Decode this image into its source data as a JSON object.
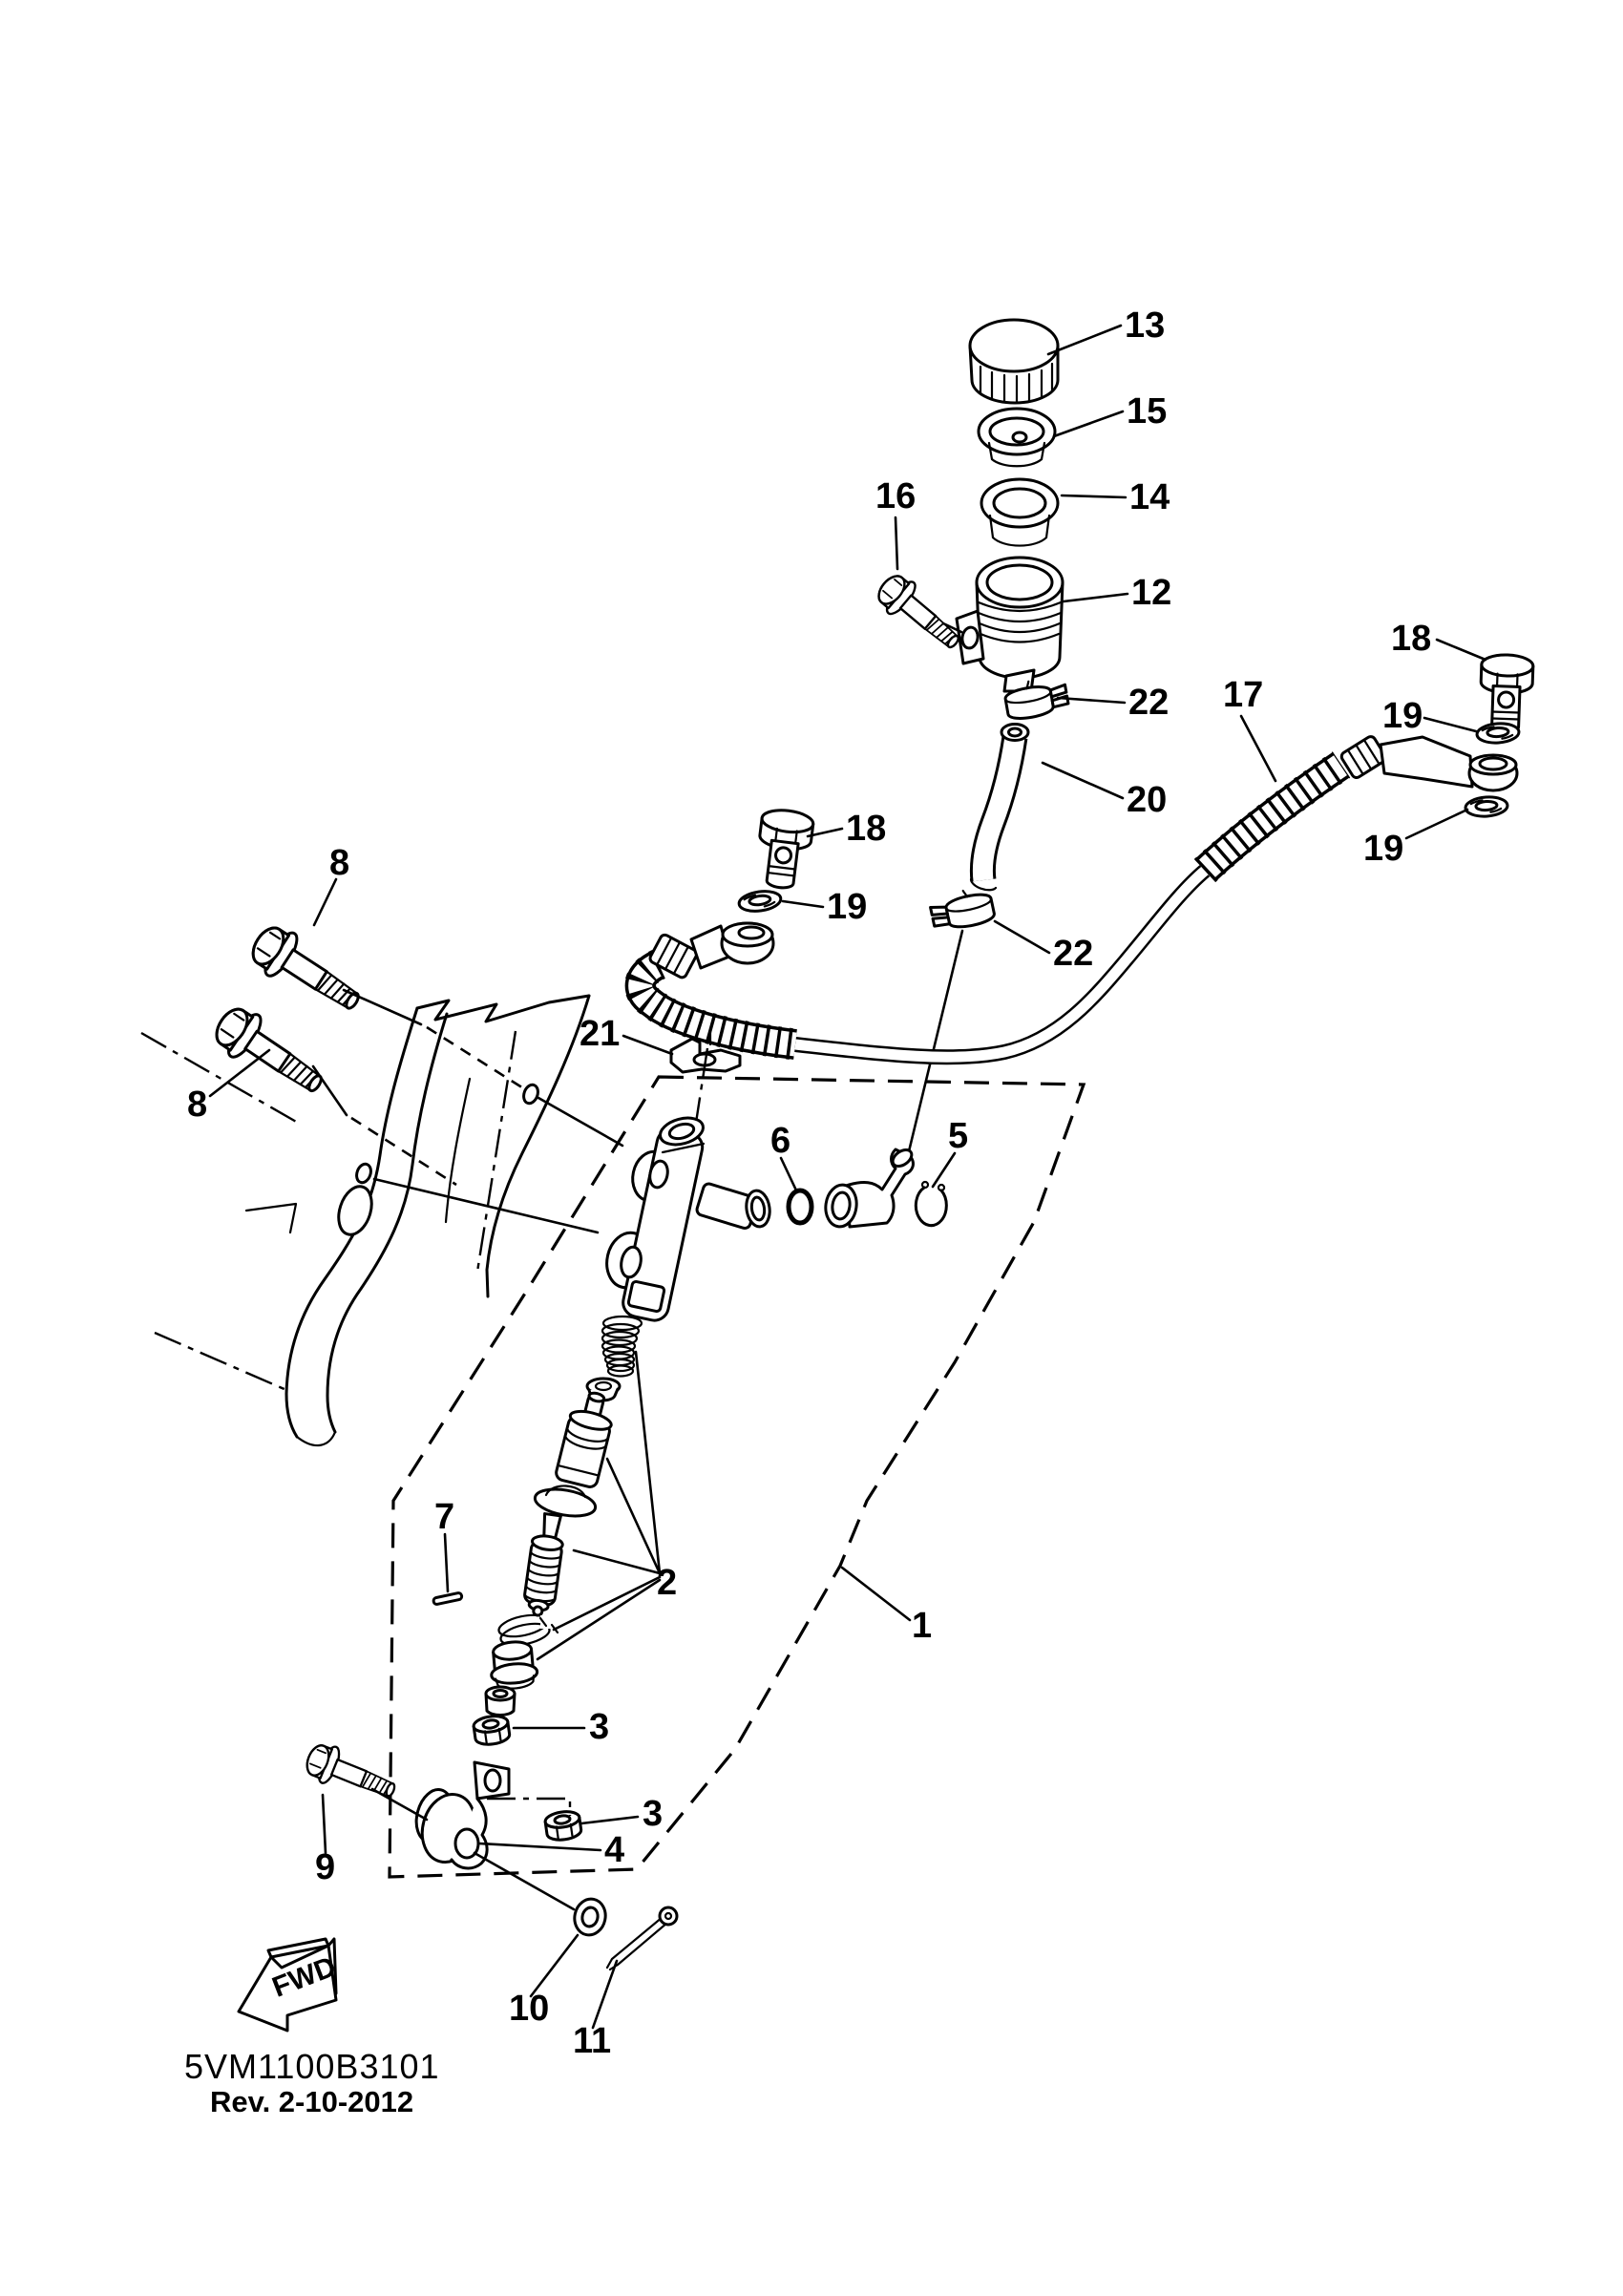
{
  "page": {
    "background": "#ffffff",
    "ink": "#000000"
  },
  "document": {
    "drawing_code": "5VM1100B3101",
    "revision": "Rev. 2-10-2012",
    "fwd_label": "FWD"
  },
  "callouts": [
    {
      "id": "13",
      "text": "13"
    },
    {
      "id": "15",
      "text": "15"
    },
    {
      "id": "14",
      "text": "14"
    },
    {
      "id": "16",
      "text": "16"
    },
    {
      "id": "12",
      "text": "12"
    },
    {
      "id": "22a",
      "text": "22"
    },
    {
      "id": "17",
      "text": "17"
    },
    {
      "id": "20",
      "text": "20"
    },
    {
      "id": "18a",
      "text": "18"
    },
    {
      "id": "19a",
      "text": "19"
    },
    {
      "id": "19b",
      "text": "19"
    },
    {
      "id": "18b",
      "text": "18"
    },
    {
      "id": "19c",
      "text": "19"
    },
    {
      "id": "8a",
      "text": "8"
    },
    {
      "id": "8b",
      "text": "8"
    },
    {
      "id": "21",
      "text": "21"
    },
    {
      "id": "6",
      "text": "6"
    },
    {
      "id": "5",
      "text": "5"
    },
    {
      "id": "2",
      "text": "2"
    },
    {
      "id": "7",
      "text": "7"
    },
    {
      "id": "1",
      "text": "1"
    },
    {
      "id": "3a",
      "text": "3"
    },
    {
      "id": "3b",
      "text": "3"
    },
    {
      "id": "4",
      "text": "4"
    },
    {
      "id": "9",
      "text": "9"
    },
    {
      "id": "10",
      "text": "10"
    },
    {
      "id": "11",
      "text": "11"
    },
    {
      "id": "22b",
      "text": "22"
    }
  ]
}
